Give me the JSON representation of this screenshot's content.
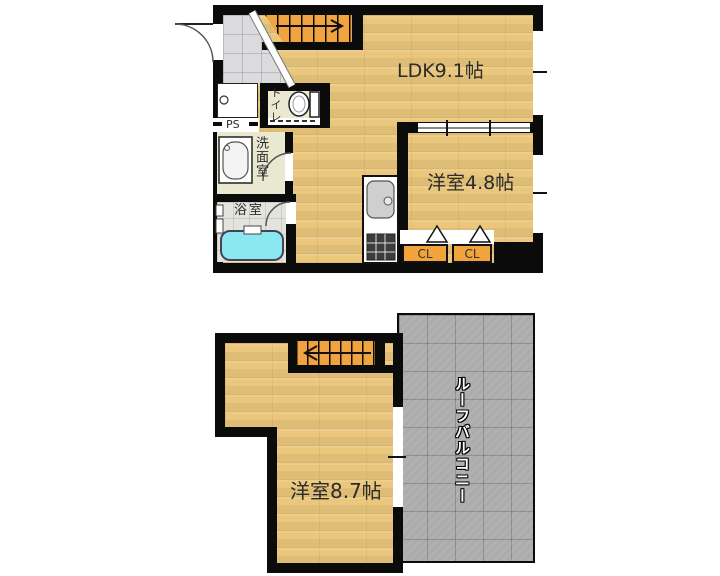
{
  "floorplan": {
    "upper_floor": {
      "rooms": {
        "ldk": {
          "label": "LDK9.1帖"
        },
        "bedroom": {
          "label": "洋室4.8帖"
        },
        "toilet": {
          "label": "トイレ"
        },
        "washroom": {
          "label": "洗面室"
        },
        "bathroom": {
          "label": "浴室"
        },
        "pipe_space": {
          "label": "PS"
        },
        "closet1": {
          "label": "CL"
        },
        "closet2": {
          "label": "CL"
        }
      }
    },
    "lower_floor": {
      "rooms": {
        "bedroom": {
          "label": "洋室8.7帖"
        },
        "roof_balcony": {
          "label": "ルーフバルコニー"
        }
      }
    },
    "colors": {
      "floor_wood": "#EAC77C",
      "stairs_orange": "#F0A441",
      "closet_orange": "#F2A33C",
      "balcony_gray": "#ACACAC",
      "bathtub_cyan": "#8BE8F1",
      "entrance_tile_gray": "#DBDBDE",
      "bathroom_tile_gray": "#E4E4DF",
      "sanitary_beige": "#EBE8D2",
      "wall_black": "#0B0B0B"
    }
  }
}
